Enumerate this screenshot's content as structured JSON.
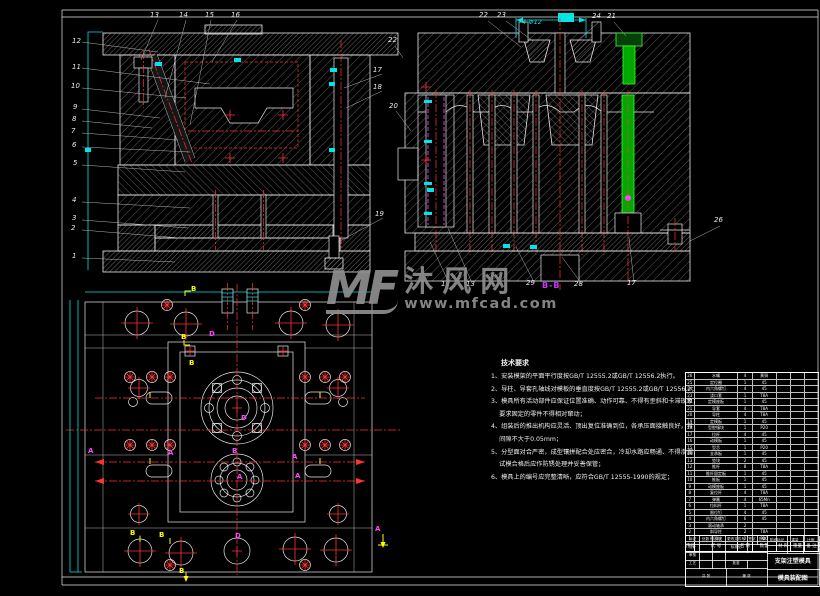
{
  "watermark": {
    "logo": "MF",
    "site": "沐风网",
    "url": "www.mfcad.com"
  },
  "labels": {
    "section_bb": "B-B",
    "dim_top": "4-Φ12",
    "mark_a": "A",
    "mark_b": "B",
    "mark_d": "D"
  },
  "callouts": {
    "fl": [
      "12",
      "11",
      "10",
      "9",
      "8",
      "7",
      "6",
      "5",
      "4",
      "3",
      "2",
      "1"
    ],
    "ft": [
      "13",
      "14",
      "15",
      "16"
    ],
    "fr": [
      "22",
      "17",
      "18",
      "20",
      "19"
    ],
    "st": [
      "22",
      "23",
      "24",
      "21"
    ],
    "sb": [
      "12",
      "13",
      "29",
      "28",
      "17"
    ],
    "sr": [
      "26"
    ]
  },
  "tech": {
    "title": "技术要求",
    "lines": [
      "1、安装模架的平面平行度按GB/T 12555.2或GB/T 12556.2执行。",
      "2、导柱、导套孔轴线对模板的垂直度按GB/T 12555.2或GB/T 12556.2；",
      "3、模具所有活动部件应保证位置准确、动作可靠、不得有歪斜和卡滞现象；",
      "　 要求固定的零件不得相对窜动；",
      "4、组装后的推出机构应灵活、顶出复位准确到位，各承压面接触良好，其",
      "　 间隙不大于0.05mm；",
      "5、分型面对合严密，成型镶拼配合处应密合，冷却水路应畅通、不得渗漏，",
      "　 试模合格后应作防锈处理并妥善保管；",
      "6、模具上的编号应完整清晰，应符合GB/T 12555-1990的规定；"
    ]
  },
  "bom": {
    "headers": [
      "序号",
      "代 号",
      "名 称",
      "数量",
      "材 料",
      "重量",
      "备 注"
    ],
    "rows": [
      [
        "26",
        "水嘴",
        "4",
        "黄铜"
      ],
      [
        "25",
        "定位圈",
        "1",
        "45"
      ],
      [
        "24",
        "内六角螺钉",
        "4",
        "45"
      ],
      [
        "23",
        "浇口套",
        "1",
        "T8A"
      ],
      [
        "22",
        "定模座板",
        "1",
        "45"
      ],
      [
        "21",
        "导套",
        "4",
        "T8A"
      ],
      [
        "20",
        "导柱",
        "4",
        "T8A"
      ],
      [
        "19",
        "定模板",
        "1",
        "45"
      ],
      [
        "18",
        "型腔镶块",
        "1",
        "P20"
      ],
      [
        "17",
        "拉杆",
        "4",
        "45"
      ],
      [
        "16",
        "动模板",
        "1",
        "45"
      ],
      [
        "15",
        "型芯",
        "1",
        "P20"
      ],
      [
        "14",
        "支承板",
        "1",
        "45"
      ],
      [
        "13",
        "垫块",
        "2",
        "45"
      ],
      [
        "12",
        "推杆",
        "8",
        "T8A"
      ],
      [
        "11",
        "推杆固定板",
        "1",
        "45"
      ],
      [
        "10",
        "推板",
        "1",
        "45"
      ],
      [
        "9",
        "动模座板",
        "1",
        "45"
      ],
      [
        "8",
        "复位杆",
        "4",
        "T8A"
      ],
      [
        "7",
        "弹簧",
        "4",
        "65Mn"
      ],
      [
        "6",
        "拉料杆",
        "1",
        "T8A"
      ],
      [
        "5",
        "限位钉",
        "4",
        "45"
      ],
      [
        "4",
        "内六角螺钉",
        "6",
        "45"
      ],
      [
        "3",
        "滚动轴承",
        "2",
        ""
      ],
      [
        "2",
        "斜导柱",
        "2",
        "T8A"
      ],
      [
        "1",
        "侧滑块",
        "2",
        "P20"
      ]
    ]
  },
  "title_block": {
    "row1": [
      "标记",
      "处数",
      "分区",
      "更改文件号",
      "签字",
      "日期"
    ],
    "design": "设计",
    "check": "审核",
    "process": "工艺",
    "std": "标准化",
    "approve": "批准",
    "stage": "阶段标记",
    "weight": "重量",
    "scale": "比例",
    "sheets": "共 张",
    "page": "第 张",
    "name1": "支架注塑模具",
    "name2": "模具装配图"
  }
}
